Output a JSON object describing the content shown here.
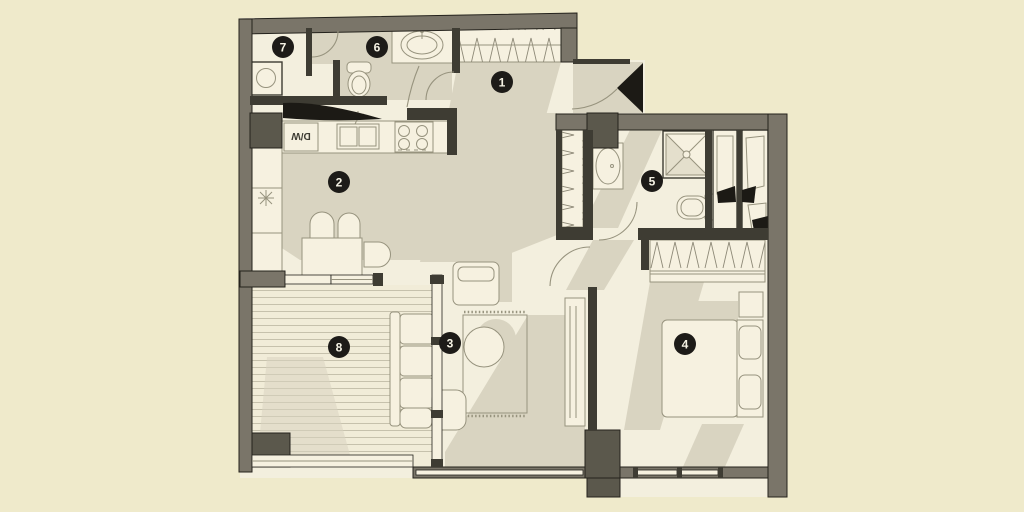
{
  "plan": {
    "type": "apartment-floor-plan",
    "rooms": [
      {
        "number": "1",
        "name": "entrance-hall"
      },
      {
        "number": "2",
        "name": "kitchen-dining"
      },
      {
        "number": "3",
        "name": "living-room"
      },
      {
        "number": "4",
        "name": "bedroom"
      },
      {
        "number": "5",
        "name": "bathroom"
      },
      {
        "number": "6",
        "name": "wc"
      },
      {
        "number": "7",
        "name": "laundry"
      },
      {
        "number": "8",
        "name": "balcony"
      }
    ],
    "labels": {
      "dishwasher": "D/W"
    }
  },
  "colors": {
    "page": "#efeacb",
    "floor": "#f3efde",
    "shadow": "#d9d4c1",
    "wall": "#7a7569",
    "pillar": "#5b584c",
    "thin": "#3e3c33",
    "black": "#1c1a15",
    "furn": "#f6f1e0",
    "furnline": "#97937e",
    "deck": "#f1ecd8",
    "deckline": "#c6c1ac",
    "hatch": "#8d8977",
    "badge": "#1d1b18",
    "badgetext": "#f5f2e4",
    "line": "#24221c"
  }
}
